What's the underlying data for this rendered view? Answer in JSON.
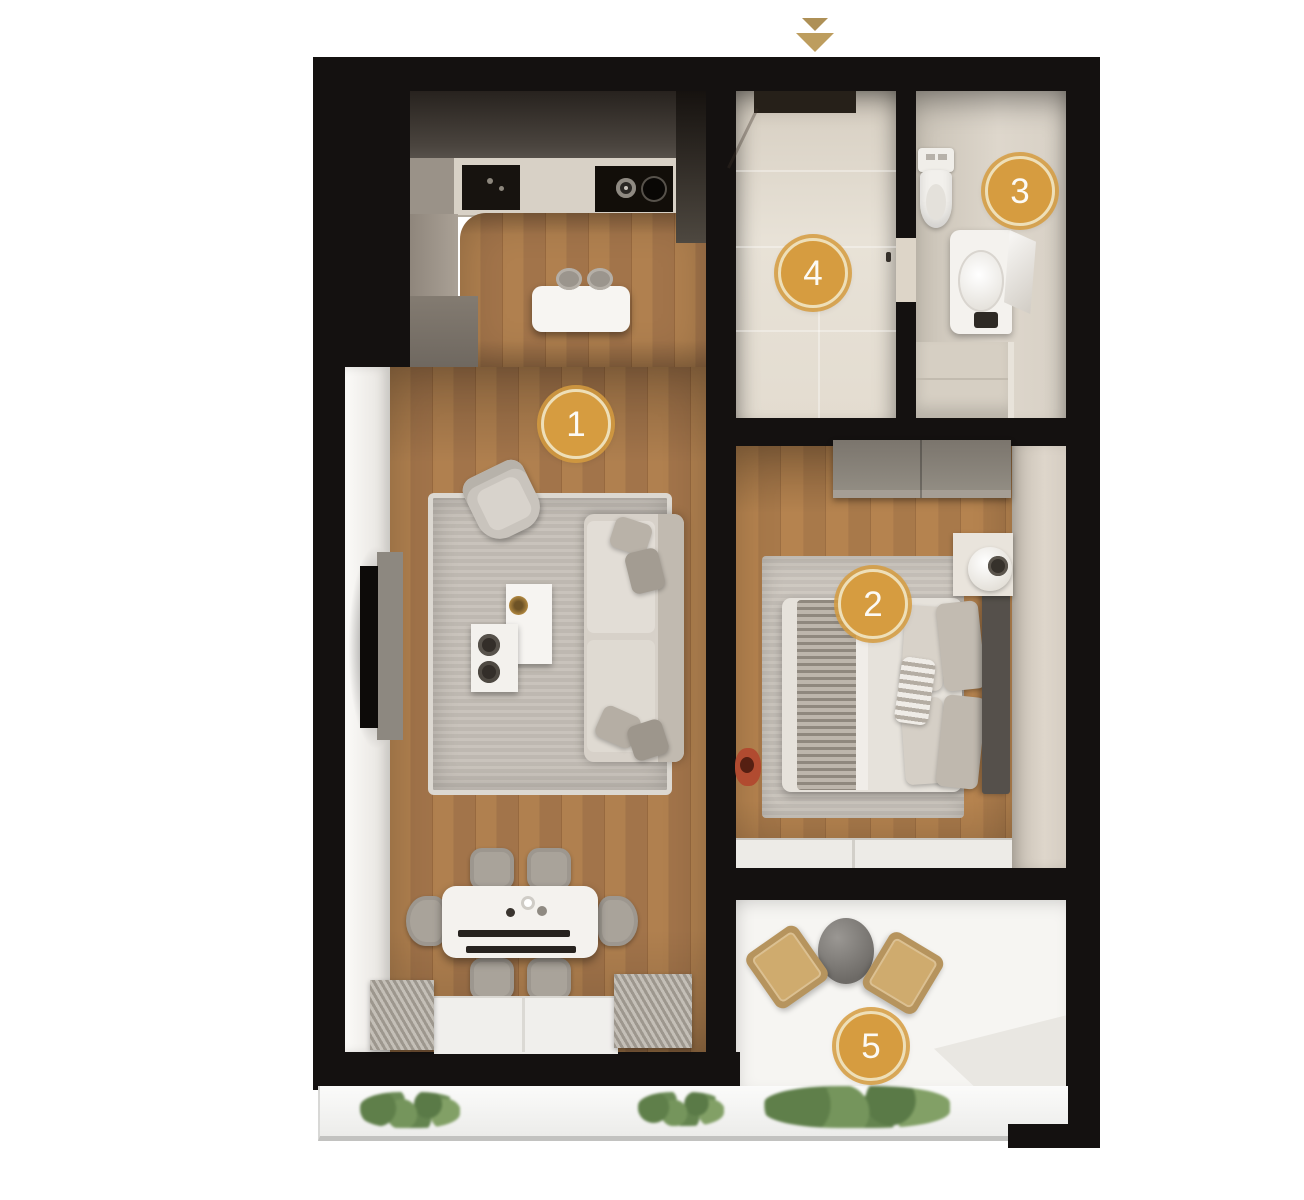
{
  "plan": {
    "markers": [
      {
        "id": 1,
        "label": "1"
      },
      {
        "id": 2,
        "label": "2"
      },
      {
        "id": 3,
        "label": "3"
      },
      {
        "id": 4,
        "label": "4"
      },
      {
        "id": 5,
        "label": "5"
      }
    ],
    "entrance_indicator_icon": "double-chevron-down-icon"
  },
  "colors": {
    "marker_fill": "#d69c40",
    "marker_ring": "#eedfb8",
    "marker_text": "#fcfaf5",
    "arrow_gold": "#bd9d5e",
    "wall_black": "#141110",
    "wood_light": "#b0804f",
    "wood_dark": "#a2744a",
    "tile_beige": "#e0d9cd",
    "rug_gray": "#c6c0b8",
    "balcony_white": "#f6f5f2",
    "plant_green": "#6a8a55",
    "chair_tan": "#cfab6e"
  }
}
